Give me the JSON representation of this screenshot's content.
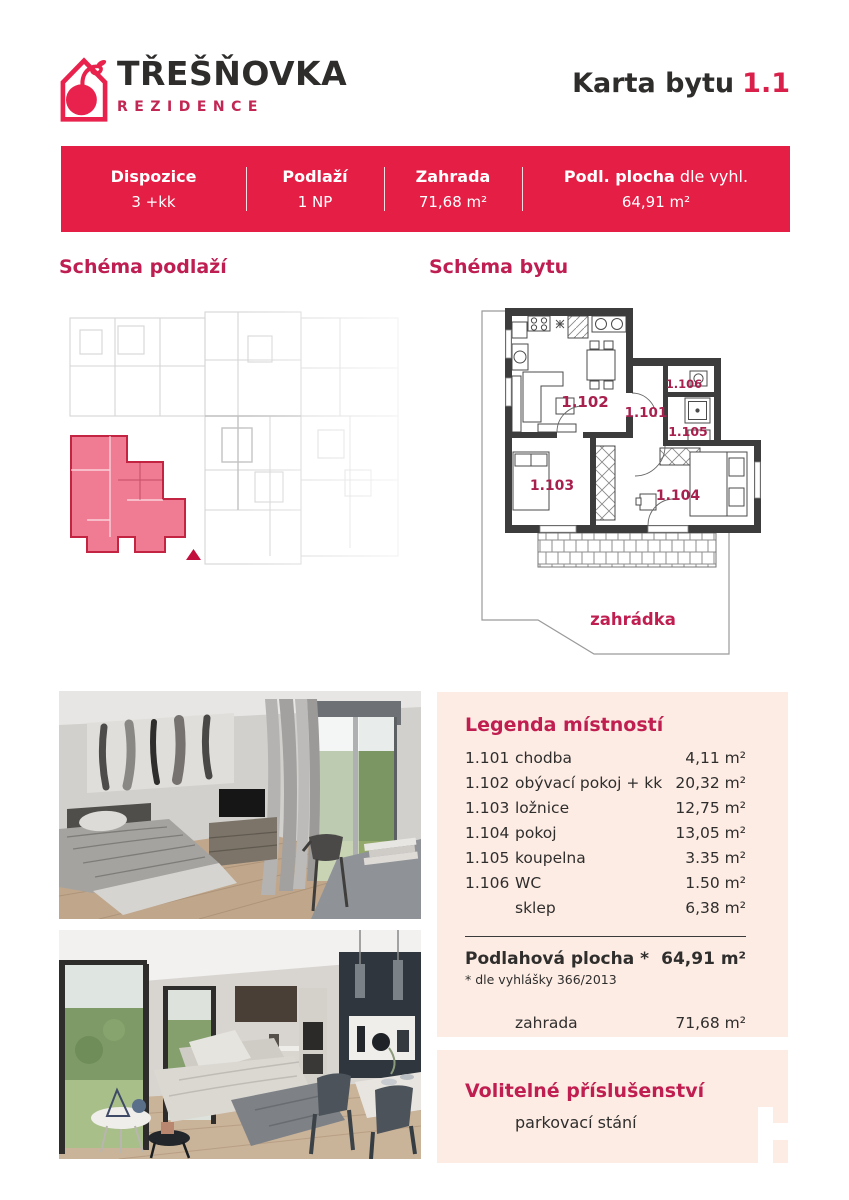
{
  "colors": {
    "brand_red": "#e51e45",
    "crimson_heading": "#c01e50",
    "logo_red": "#e8224c",
    "peach_panel": "#fdece4",
    "plan_highlight_pink": "#ef7c93",
    "dark_text": "#2f2e2d"
  },
  "brand": {
    "name": "TŘEŠŇOVKA",
    "subtitle": "REZIDENCE"
  },
  "header": {
    "card_label": "Karta bytu",
    "unit_number": "1.1"
  },
  "banner": {
    "columns": [
      {
        "label": "Dispozice",
        "value": "3 +kk"
      },
      {
        "label": "Podlaží",
        "value": "1 NP"
      },
      {
        "label": "Zahrada",
        "value": "71,68 m²"
      },
      {
        "label": "Podl. plocha",
        "label_suffix": " dle vyhl.",
        "value": "64,91 m²"
      }
    ]
  },
  "sections": {
    "floor_schema_title": "Schéma podlaží",
    "unit_schema_title": "Schéma bytu"
  },
  "floor_plan": {
    "room_labels": [
      "1.101",
      "1.102",
      "1.103",
      "1.104",
      "1.105",
      "1.106"
    ],
    "garden_label": "zahrádka"
  },
  "legend": {
    "title": "Legenda místností",
    "rows": [
      {
        "id": "1.101",
        "name": "chodba",
        "area": "4,11 m²"
      },
      {
        "id": "1.102",
        "name": "obývací pokoj + kk",
        "area": "20,32 m²"
      },
      {
        "id": "1.103",
        "name": "ložnice",
        "area": "12,75 m²"
      },
      {
        "id": "1.104",
        "name": "pokoj",
        "area": "13,05 m²"
      },
      {
        "id": "1.105",
        "name": "koupelna",
        "area": "3.35 m²"
      },
      {
        "id": "1.106",
        "name": "WC",
        "area": "1.50 m²"
      },
      {
        "id": "",
        "name": "sklep",
        "area": "6,38 m²"
      }
    ],
    "total_label": "Podlahová plocha *",
    "total_value": "64,91 m²",
    "footnote": "* dle vyhlášky 366/2013",
    "garden_name": "zahrada",
    "garden_value": "71,68 m²"
  },
  "options": {
    "title": "Volitelné příslušenství",
    "item": "parkovací stání"
  }
}
